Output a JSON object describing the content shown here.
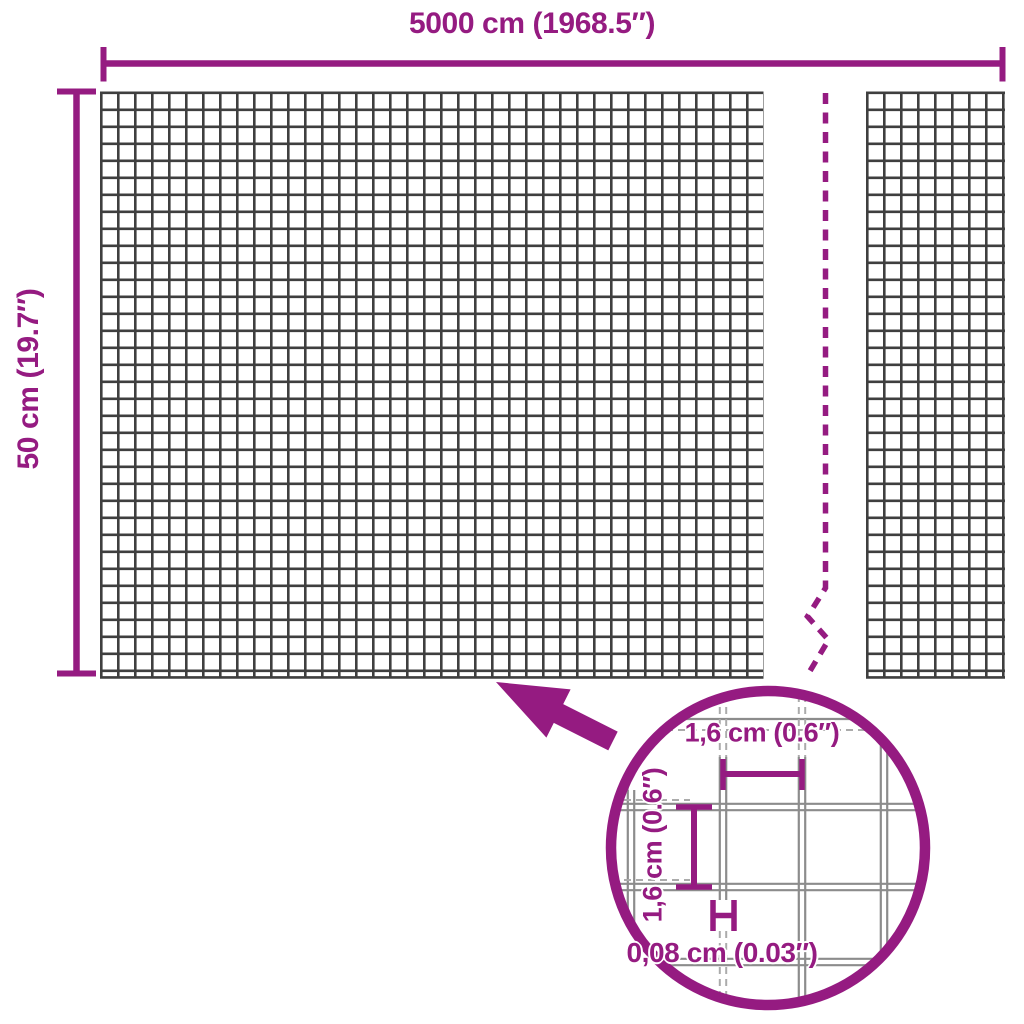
{
  "measurements": {
    "width_label": "5000 cm (1968.5″)",
    "height_label": "50 cm (19.7″)"
  },
  "magnifier": {
    "mesh_width_label": "1,6 cm (0.6″)",
    "mesh_height_label": "1,6 cm (0.6″)",
    "wire_thickness_label": "0,08 cm (0.03″)"
  },
  "colors": {
    "accent": "#951B81",
    "mesh_line": "#3F3F3F",
    "lens_wire": "#8C8C8C",
    "lens_guide": "#ABABAB",
    "background": "#FFFFFF"
  }
}
